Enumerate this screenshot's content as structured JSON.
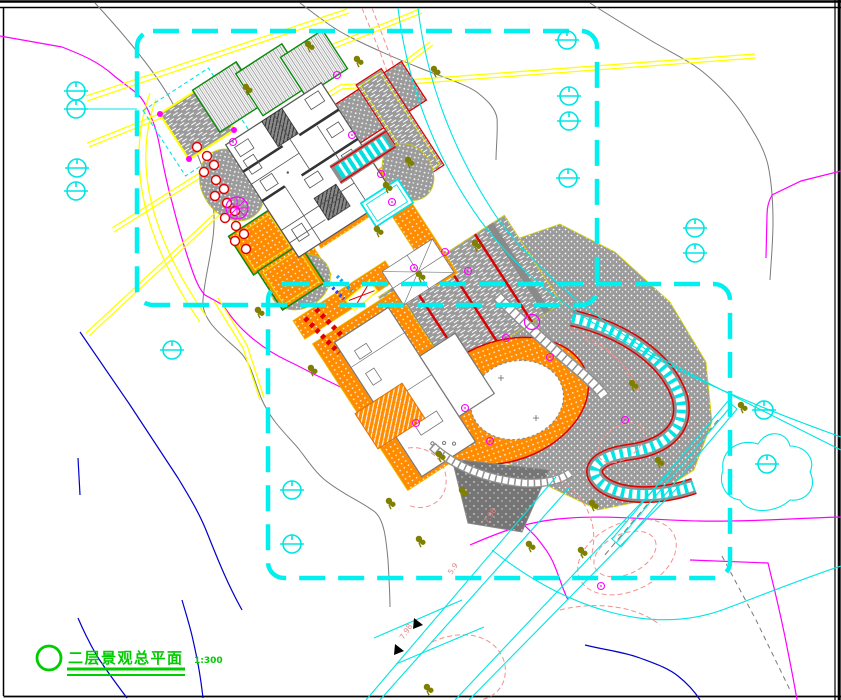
{
  "title_block": {
    "title": "二层景观总平面",
    "scale": "1:300"
  },
  "annotations": {
    "elev_a": "7.98",
    "elev_b": "5.9",
    "elev_c": "7.98"
  },
  "colors": {
    "boundary_cyan": "#00F0F0",
    "road_yellow": "#FFFF00",
    "property_magenta": "#FF00FF",
    "contour_gray": "#7A7A7A",
    "contour_blue": "#0000CC",
    "contour_pink": "#F09090",
    "paving_orange": "#FF8C00",
    "paving_gray": "#9B9B9B",
    "accent_red": "#DD0000",
    "planting_green": "#0A8A0A",
    "title_green": "#00CC00",
    "shrub_olive": "#7F7F00",
    "frame_black": "#000000"
  }
}
